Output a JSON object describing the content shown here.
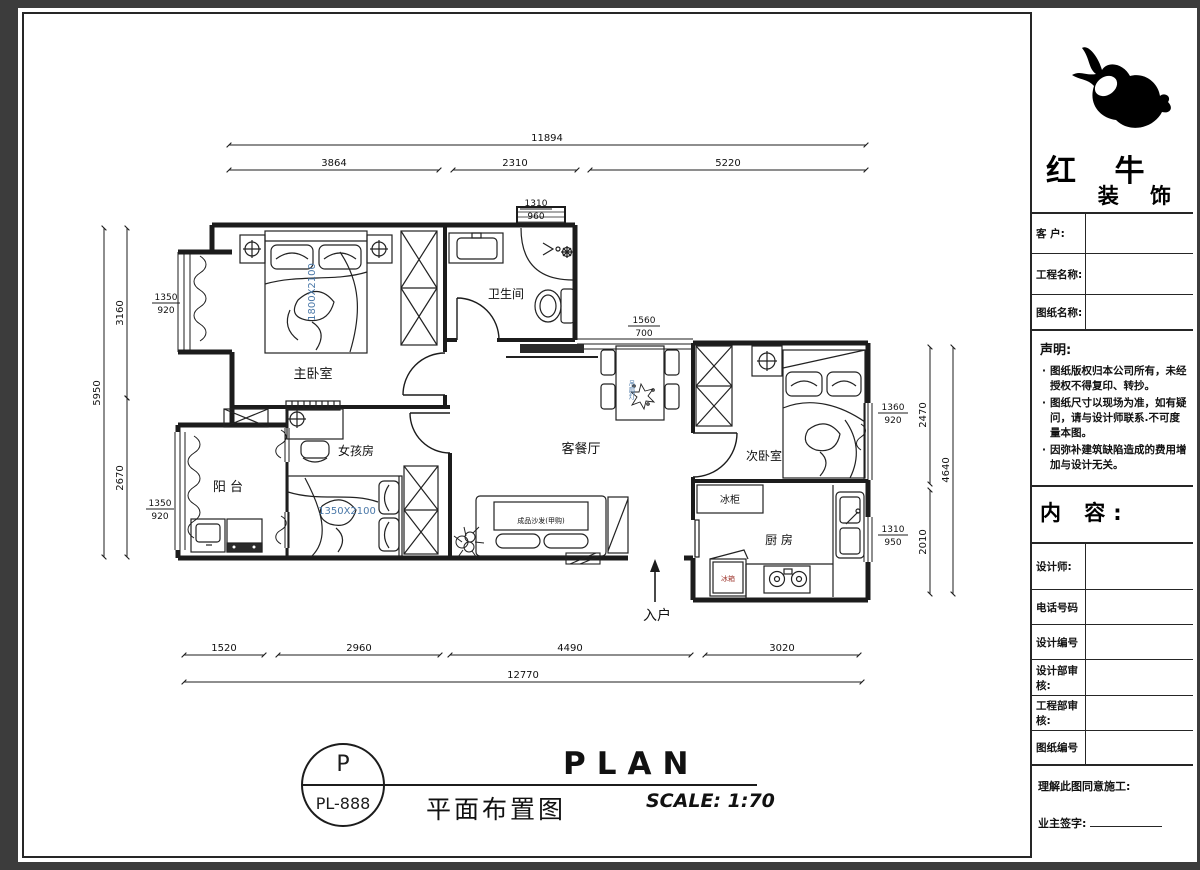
{
  "colors": {
    "line": "#1c1c1c",
    "accent_blue": "#4a78a8",
    "accent_red": "#a03b33",
    "paper": "#ffffff",
    "backdrop": "#3c3c3c"
  },
  "title_block": {
    "brand_line1": "红 牛",
    "brand_line2": "装 饰",
    "rows_top": [
      {
        "label": "客  户:"
      },
      {
        "label": "工程名称:"
      },
      {
        "label": "图纸名称:"
      }
    ],
    "statement": {
      "title": "声明:",
      "items": [
        "图纸版权归本公司所有，未经授权不得复印、转抄。",
        "图纸尺寸以现场为准，如有疑问，请与设计师联系.不可度量本图。",
        "因弥补建筑缺陷造成的费用增加与设计无关。"
      ]
    },
    "content_label": "内 容:",
    "rows_bottom": [
      "设计师:",
      "电话号码",
      "设计编号",
      "设计部审核:",
      "工程部审核:",
      "图纸编号"
    ],
    "footer": {
      "line1": "理解此图同意施工:",
      "line2": "业主签字:"
    }
  },
  "title_bar": {
    "sheet_letter": "P",
    "sheet_no": "PL-888",
    "title_cn": "平面布置图",
    "title_en": "PLAN",
    "scale": "SCALE: 1:70"
  },
  "plan": {
    "rooms": {
      "master": "主卧室",
      "bath": "卫生间",
      "living": "客餐厅",
      "second": "次卧室",
      "kitchen": "厨 房",
      "girl": "女孩房",
      "balcony": "阳  台"
    },
    "labels": {
      "freezer": "冰柜",
      "fridge": "冰箱",
      "sofa": "成品沙发(甲购)",
      "fan_lamp": "吊扇灯",
      "master_bed_size": "1800X2100",
      "girl_bed_size": "1350X2100",
      "entry": "入户"
    },
    "dims": {
      "top_total": "11894",
      "top_segments": [
        "3864",
        "2310",
        "5220"
      ],
      "bottom_segments": [
        "1520",
        "2960",
        "4490",
        "3020"
      ],
      "bottom_total": "12770",
      "left_total": "5950",
      "left_segments": [
        "3160",
        "2670"
      ],
      "right_segments": [
        "2470",
        "2010"
      ],
      "right_total": "4640",
      "windows": {
        "top": [
          "1310",
          "960"
        ],
        "dining": [
          "1560",
          "700"
        ],
        "left_upper": [
          "1350",
          "920"
        ],
        "left_lower": [
          "1350",
          "920"
        ],
        "right_upper": [
          "1360",
          "920"
        ],
        "right_lower": [
          "1310",
          "950"
        ]
      }
    }
  }
}
